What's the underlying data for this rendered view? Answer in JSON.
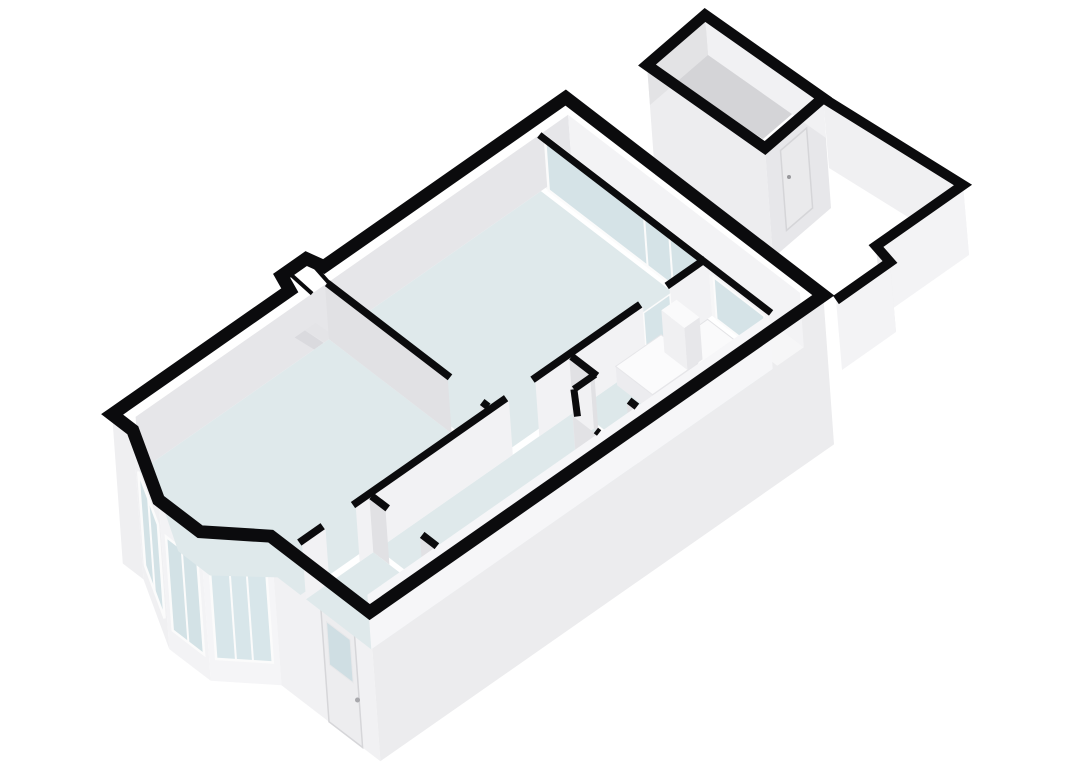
{
  "meta": {
    "title": "3d-floorplan-render",
    "canvas": {
      "width": 1080,
      "height": 764,
      "background": "#ffffff"
    }
  },
  "palette": {
    "background": "#ffffff",
    "wall_cap": "#0b0b0d",
    "floor": "#dfe9eb",
    "floor_dim": "#dde7e9",
    "patio_floor": "#f6f6f7",
    "shed_floor": "#d4d4d7",
    "glass": "#d3e2e6",
    "frame": "#fbfbfb",
    "face_light": "#f3f3f5",
    "face_mid": "#ececee",
    "face_shade": "#e1e1e4",
    "fixture": "#fafafb"
  },
  "scene": {
    "shapes": [
      {
        "name": "west-step-exterior-face",
        "type": "polygon",
        "points": "112.1,414.4 132.8,430.3 143.5,579.4 122.8,563.5",
        "fill": "#efeff1"
      },
      {
        "name": "bay-window-left-exterior-face",
        "type": "polygon",
        "points": "132.8,430.3 158.6,500.0 169.3,649.1 143.5,579.4",
        "fill": "#f0f0f2"
      },
      {
        "name": "bay-window-front-exterior-face",
        "type": "polygon",
        "points": "158.6,500.0 200.0,531.7 210.7,680.8 169.3,649.1",
        "fill": "#f3f3f5"
      },
      {
        "name": "bay-window-right-exterior-face",
        "type": "polygon",
        "points": "200.0,531.7 270.8,536.2 281.5,685.3 210.7,680.8",
        "fill": "#f5f5f7"
      },
      {
        "name": "front-entrance-exterior-face",
        "type": "polygon",
        "points": "270.8,536.2 369.7,612.1 380.4,761.2 281.5,685.3",
        "fill": "#f1f1f3"
      },
      {
        "name": "southeast-exterior-face",
        "type": "polygon",
        "points": "369.7,612.1 823.3,295.3 834.0,444.4 380.4,761.2",
        "fill": "#ececee"
      },
      {
        "name": "bay-left-window-glass",
        "type": "polygon",
        "points": "138.3,471.5 157.9,524.4 164.6,618.3 145.0,565.4",
        "fill": "#d3e2e6",
        "stroke": "#fbfbfb",
        "sw": 2.5
      },
      {
        "name": "bay-front-window-glass",
        "type": "polygon",
        "points": "166.0,536.6 197.4,560.7 204.1,654.6 172.7,630.5",
        "fill": "#d3e2e6",
        "stroke": "#fbfbfb",
        "sw": 2.5
      },
      {
        "name": "bay-right-window-glass",
        "type": "polygon",
        "points": "209.5,565.0 266.1,568.6 272.8,662.5 216.2,658.9",
        "fill": "#d8e6ea",
        "stroke": "#fbfbfb",
        "sw": 2.5
      },
      {
        "name": "bay-left-window-mullion",
        "type": "polyline",
        "points": "148.1,497.9 154.8,591.8",
        "stroke": "#fbfbfb",
        "sw": 2
      },
      {
        "name": "bay-front-window-mullion",
        "type": "polyline",
        "points": "181.7,548.6 188.4,642.5",
        "stroke": "#fbfbfb",
        "sw": 2
      },
      {
        "name": "bay-right-window-mullion-a",
        "type": "polyline",
        "points": "229.3,566.3 236.0,660.2",
        "stroke": "#fbfbfb",
        "sw": 2
      },
      {
        "name": "bay-right-window-mullion-b",
        "type": "polyline",
        "points": "246.3,567.3 253.0,661.2",
        "stroke": "#fbfbfb",
        "sw": 2
      },
      {
        "name": "front-door",
        "type": "polygon",
        "points": "319.9,595.0 353.5,620.8 362.6,747.5 329.0,721.7",
        "fill": "#ededef",
        "stroke": "#d6d6d9",
        "sw": 1.5
      },
      {
        "name": "front-door-window-glass",
        "type": "polygon",
        "points": "326.5,621.7 350.1,639.7 353.2,682.8 329.6,664.8",
        "fill": "#cfdee3",
        "stroke": "#e8e8ea",
        "sw": 1
      },
      {
        "name": "front-door-handle",
        "type": "circle",
        "cx": 357.5,
        "cy": 700,
        "r": 2.5,
        "fill": "#a8a8ac"
      },
      {
        "name": "living-room-floor",
        "type": "polygon",
        "points": "139.5,471.5 328.9,339.2 489.9,462.7 300.5,595.0 277.5,577.4 209.9,575.5 178.2,551.1 155.1,483.5",
        "fill": "#dfe9eb"
      },
      {
        "name": "entrance-hall-floor",
        "type": "polygon",
        "points": "306.0,599.3 373.3,552.3 438.6,602.4 371.3,649.4",
        "fill": "#dfe9eb"
      },
      {
        "name": "corridor-floor",
        "type": "polygon",
        "points": "377.8,549.1 573.2,412.6 638.5,462.7 443.1,599.2",
        "fill": "#dfe9eb"
      },
      {
        "name": "wc-floor",
        "type": "polygon",
        "points": "576.9,440.4 593.9,428.6 638.5,462.7 605.3,486.0 575.9,463.4",
        "fill": "#dde7e9"
      },
      {
        "name": "bedroom-floor",
        "type": "polygon",
        "points": "333.4,336.1 540.9,191.1 701.9,314.7 494.4,459.7",
        "fill": "#dfe9eb"
      },
      {
        "name": "bathroom-floor",
        "type": "polygon",
        "points": "577.8,409.5 707.5,318.9 772.8,369.0 643.1,459.6",
        "fill": "#dde8ea"
      },
      {
        "name": "patio-floor",
        "type": "polygon",
        "points": "545.5,187.9 572.0,169.4 803.8,347.3 777.3,365.8",
        "fill": "#f6f6f7"
      },
      {
        "name": "northwest-wall-interior-face",
        "type": "polygon",
        "points": "139.5,471.5 572.0,169.4 568.1,114.8 135.6,416.9",
        "fill": "#e6e6e9"
      },
      {
        "name": "chimney-niche-a",
        "type": "polygon",
        "points": "314.1,349.5 294.7,337.5 304.9,330.4 323.5,342.9",
        "fill": "#dadade"
      },
      {
        "name": "chimney-niche-b",
        "type": "polygon",
        "points": "324.7,342.1 305.3,330.1 315.5,323.0 334.1,335.5",
        "fill": "#e4e4e7"
      },
      {
        "name": "northeast-end-wall-interior-face",
        "type": "polygon",
        "points": "572.0,169.4 803.8,347.3 799.9,292.7 568.1,114.8",
        "fill": "#f3f3f5"
      },
      {
        "name": "bedroom-sliding-door-glass",
        "type": "polygon",
        "points": "548.7,190.4 702.8,308.6 698.9,254.0 544.8,135.8",
        "fill": "#d5e3e7",
        "stroke": "#fbfbfb",
        "sw": 2.5
      },
      {
        "name": "bedroom-sliding-door-mullion-a",
        "type": "polyline",
        "points": "647.6,266.3 644.1,218.0",
        "stroke": "#fbfbfb",
        "sw": 2
      },
      {
        "name": "bedroom-sliding-door-mullion-b",
        "type": "polyline",
        "points": "672.9,285.7 669.4,237.4",
        "stroke": "#fbfbfb",
        "sw": 2
      },
      {
        "name": "bathroom-patio-window-glass",
        "type": "polygon",
        "points": "716.6,319.2 767.2,358.0 764.2,316.0 713.6,277.2",
        "fill": "#d5e3e7",
        "stroke": "#fbfbfb",
        "sw": 2
      },
      {
        "name": "living-bedroom-divider-face-a",
        "type": "polygon",
        "points": "328.9,339.2 451.7,433.5 447.8,378.9 325.0,284.6",
        "fill": "#e1e1e4"
      },
      {
        "name": "living-bedroom-divider-face-b",
        "type": "polygon",
        "points": "483.9,458.2 489.9,462.7 486.0,408.1 480.0,403.6",
        "fill": "#e1e1e4"
      },
      {
        "name": "spine-wall-face-a",
        "type": "polygon",
        "points": "306.0,599.3 329.4,582.9 325.5,528.3 302.1,544.7",
        "fill": "#f2f2f4"
      },
      {
        "name": "spine-wall-face-b",
        "type": "polygon",
        "points": "359.7,561.8 512.8,454.9 508.9,400.3 355.8,507.2",
        "fill": "#f2f2f4"
      },
      {
        "name": "spine-wall-face-c",
        "type": "polygon",
        "points": "539.3,436.4 647.0,361.2 643.1,306.6 535.4,381.8",
        "fill": "#f2f2f4"
      },
      {
        "name": "spine-wall-face-d",
        "type": "polygon",
        "points": "673.4,342.7 712.0,315.7 708.1,261.1 669.5,288.1",
        "fill": "#f2f2f4"
      },
      {
        "name": "bedroom-bathroom-glazed-door",
        "type": "polygon",
        "points": "646.8,359.1 673.2,340.6 669.9,294.4 643.5,312.9",
        "fill": "#d6e4e8",
        "stroke": "#fbfbfb",
        "sw": 1.5
      },
      {
        "name": "hall-divider-face-a",
        "type": "polygon",
        "points": "373.3,552.3 389.4,564.6 385.5,510.0 369.4,497.7",
        "fill": "#e1e1e4"
      },
      {
        "name": "hall-divider-face-b",
        "type": "polygon",
        "points": "423.9,591.1 438.6,602.4 434.7,547.8 420.0,536.5",
        "fill": "#e1e1e4"
      },
      {
        "name": "corridor-bathroom-wall-face-a",
        "type": "polygon",
        "points": "573.2,412.6 598.5,432.1 594.6,377.5 569.3,358.0",
        "fill": "#e1e1e4"
      },
      {
        "name": "corridor-bathroom-wall-face-b",
        "type": "polygon",
        "points": "630.7,456.8 638.5,462.7 634.6,408.1 626.8,402.2",
        "fill": "#e1e1e4"
      },
      {
        "name": "wc-north-wall-face",
        "type": "polygon",
        "points": "576.9,440.4 593.9,428.6 590.0,374.0 573.0,385.8",
        "fill": "#f1f1f3"
      },
      {
        "name": "wc-angled-wall-face",
        "type": "polygon",
        "points": "576.9,440.4 575.9,463.4 572.0,408.8 573.0,385.8",
        "fill": "#e9e9ec"
      },
      {
        "name": "wc-west-wall-face",
        "type": "polygon",
        "points": "576.8,470.8 600.7,489.2 596.8,434.6 572.9,416.2",
        "fill": "#e2e2e5"
      },
      {
        "name": "shower-tray",
        "type": "polygon",
        "points": "671.7,344.5 707.6,319.4 768.3,366.0 732.4,391.1",
        "fill": "#fafafb",
        "stroke": "#e3e3e6",
        "sw": 1
      },
      {
        "name": "vanity-counter-front-face",
        "type": "polygon",
        "points": "617.1,385.3 653.9,413.5 652.5,394.6 615.7,366.4",
        "fill": "#ececef"
      },
      {
        "name": "vanity-counter-side-face",
        "type": "polygon",
        "points": "653.9,413.5 699.3,381.8 697.9,362.9 652.5,394.6",
        "fill": "#e4e4e7"
      },
      {
        "name": "vanity-counter-top",
        "type": "polygon",
        "points": "615.7,366.4 661.1,334.7 697.9,362.9 652.5,394.6",
        "fill": "#fbfbfc",
        "stroke": "#e6e6e9",
        "sw": 1
      },
      {
        "name": "boiler-cabinet-front-face",
        "type": "polygon",
        "points": "664.4,352.3 687.4,370.0 684.4,328.0 661.4,310.3",
        "fill": "#f0f0f2"
      },
      {
        "name": "boiler-cabinet-side-face",
        "type": "polygon",
        "points": "687.4,370.0 702.5,359.4 699.5,317.4 684.4,328.0",
        "fill": "#e7e7ea"
      },
      {
        "name": "boiler-cabinet-top",
        "type": "polygon",
        "points": "661.4,310.3 676.5,299.7 699.5,317.4 684.4,328.0",
        "fill": "#fafafb"
      },
      {
        "name": "southeast-wall-interior-face",
        "type": "polygon",
        "points": "371.3,649.4 772.7,369.0 768.8,314.4 367.4,594.8",
        "fill": "#f6f6f8"
      },
      {
        "name": "shed-southwest-exterior-face",
        "type": "polygon",
        "points": "647,65 765,148 773,258 655,175",
        "fill": "#ededef"
      },
      {
        "name": "shed-southeast-exterior-face",
        "type": "polygon",
        "points": "765,148 823,98 831,208 773,258",
        "fill": "#e7e7ea"
      },
      {
        "name": "shed-door",
        "type": "polygon",
        "points": "780.5,150.5 806.6,128.0 812.6,208.0 786.5,230.5",
        "fill": "#eaeaec",
        "stroke": "#d5d5d8",
        "sw": 1.5
      },
      {
        "name": "shed-door-handle",
        "type": "circle",
        "cx": 789,
        "cy": 177,
        "r": 2,
        "fill": "#98989c"
      },
      {
        "name": "shed-floor",
        "type": "polygon",
        "points": "652,70 700,26 812,97 763,139",
        "fill": "#d4d4d7"
      },
      {
        "name": "shed-northwest-interior-face",
        "type": "polygon",
        "points": "647,65 705,15 708,55 650,105",
        "fill": "#e3e3e5"
      },
      {
        "name": "shed-northeast-interior-face",
        "type": "polygon",
        "points": "705,15 823,98 826,138 708,55",
        "fill": "#f1f1f3"
      },
      {
        "name": "garden-wall-northeast-face",
        "type": "polygon",
        "points": "823,98 963,185 969,255 829,168",
        "fill": "#f0f0f2"
      },
      {
        "name": "garden-wall-southeast-face",
        "type": "polygon",
        "points": "963,185 876,246 882,316 969,255",
        "fill": "#f3f3f5"
      },
      {
        "name": "garden-wall-jog-face",
        "type": "polygon",
        "points": "876,246 890,262 896,332 882,316",
        "fill": "#e9e9eb"
      },
      {
        "name": "garden-wall-end-face",
        "type": "polygon",
        "points": "890,262 836,300 842,370 896,332",
        "fill": "#f3f3f5"
      }
    ],
    "wall_caps": [
      {
        "name": "main-exterior-wall-cap",
        "points": "112.1,414.4 289.8,290.3 281.6,275.8 306.2,258.6 323.8,266.6 565.7,97.6 823.3,295.3 369.7,612.1 270.8,536.2 200.0,531.7 158.6,500.0 132.8,430.3",
        "width": 13,
        "closed": true
      },
      {
        "name": "chimney-cap-tick-a",
        "points": "312.1,293.6 288.0,272.0",
        "width": 4,
        "closed": false
      },
      {
        "name": "chimney-cap-tick-b",
        "points": "328.4,282.3 307.0,258.0",
        "width": 4,
        "closed": false
      },
      {
        "name": "spine-wall-cap-a",
        "points": "299.3,542.6 322.7,526.2",
        "width": 7.5,
        "closed": false
      },
      {
        "name": "spine-wall-cap-b",
        "points": "353.0,505.1 506.1,398.2",
        "width": 7.5,
        "closed": false
      },
      {
        "name": "spine-wall-cap-c",
        "points": "532.5,379.7 640.2,304.4",
        "width": 7.5,
        "closed": false
      },
      {
        "name": "spine-wall-cap-d",
        "points": "666.7,286.0 705.3,259.1",
        "width": 7.5,
        "closed": false
      },
      {
        "name": "hall-divider-cap-a",
        "points": "371.6,496.1 387.7,508.4",
        "width": 7.5,
        "closed": false
      },
      {
        "name": "hall-divider-cap-b",
        "points": "422.2,534.9 436.9,546.2",
        "width": 7.5,
        "closed": false
      },
      {
        "name": "living-bedroom-divider-cap-a",
        "points": "327.2,283.1 450.0,377.3",
        "width": 7.5,
        "closed": false
      },
      {
        "name": "living-bedroom-divider-cap-b",
        "points": "482.2,402.0 488.2,406.6",
        "width": 7.5,
        "closed": false
      },
      {
        "name": "corridor-bathroom-wall-cap-a",
        "points": "571.6,356.5 596.9,375.9",
        "width": 7.5,
        "closed": false
      },
      {
        "name": "corridor-bathroom-wall-cap-b",
        "points": "629.1,400.6 636.9,406.6",
        "width": 7.5,
        "closed": false
      },
      {
        "name": "wc-wall-cap-a",
        "points": "595.1,374.5 573.9,389.3",
        "width": 7,
        "closed": false
      },
      {
        "name": "wc-wall-cap-angled",
        "points": "573.9,389.3 577.5,416.4",
        "width": 7,
        "closed": false
      },
      {
        "name": "wc-wall-cap-b",
        "points": "595.9,430.5 599.1,433.0",
        "width": 7,
        "closed": false
      },
      {
        "name": "glazed-wall-cap",
        "points": "539.3,135.0 771.1,312.9",
        "width": 7,
        "closed": false
      },
      {
        "name": "shed-wall-cap",
        "points": "647,65 705,15 823,98 765,148",
        "width": 11,
        "closed": true
      },
      {
        "name": "garden-wall-cap",
        "points": "823,98 963,185 876,246 890,262 836,300",
        "width": 10,
        "closed": false
      }
    ]
  }
}
